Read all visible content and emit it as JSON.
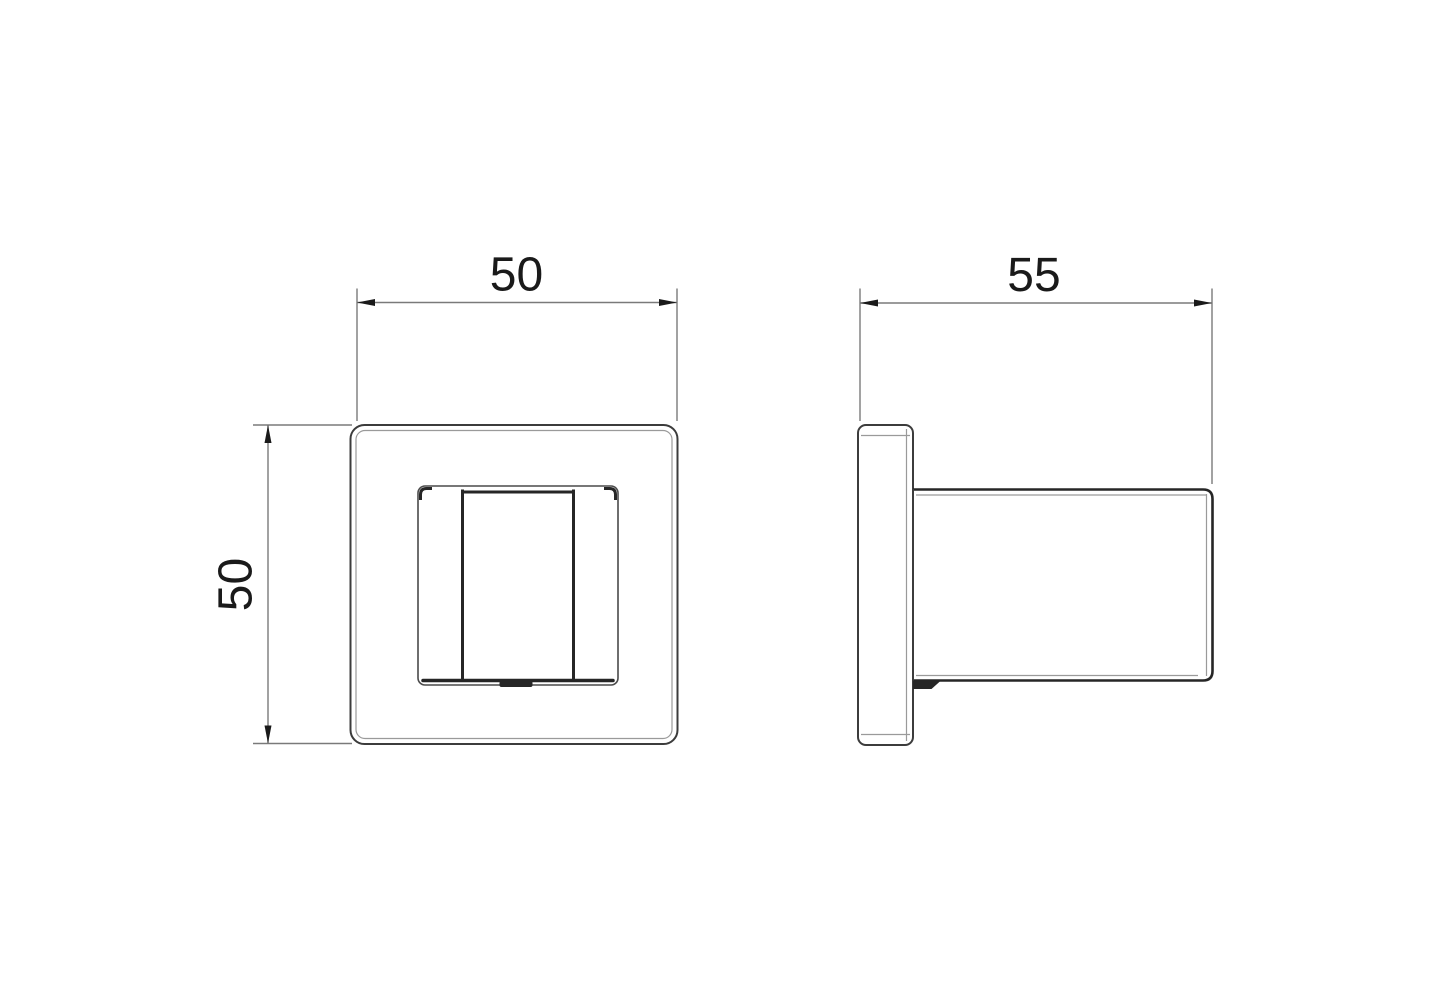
{
  "drawing": {
    "background": "#ffffff",
    "colors": {
      "bg": "#ffffff",
      "main": "#3c3c3c",
      "thick": "#262626",
      "thin": "#9a9a9a",
      "dim": "#7a7a7a",
      "text": "#1a1a1a"
    },
    "dimensions": {
      "front_width": "50",
      "front_height": "50",
      "side_depth": "55"
    }
  }
}
